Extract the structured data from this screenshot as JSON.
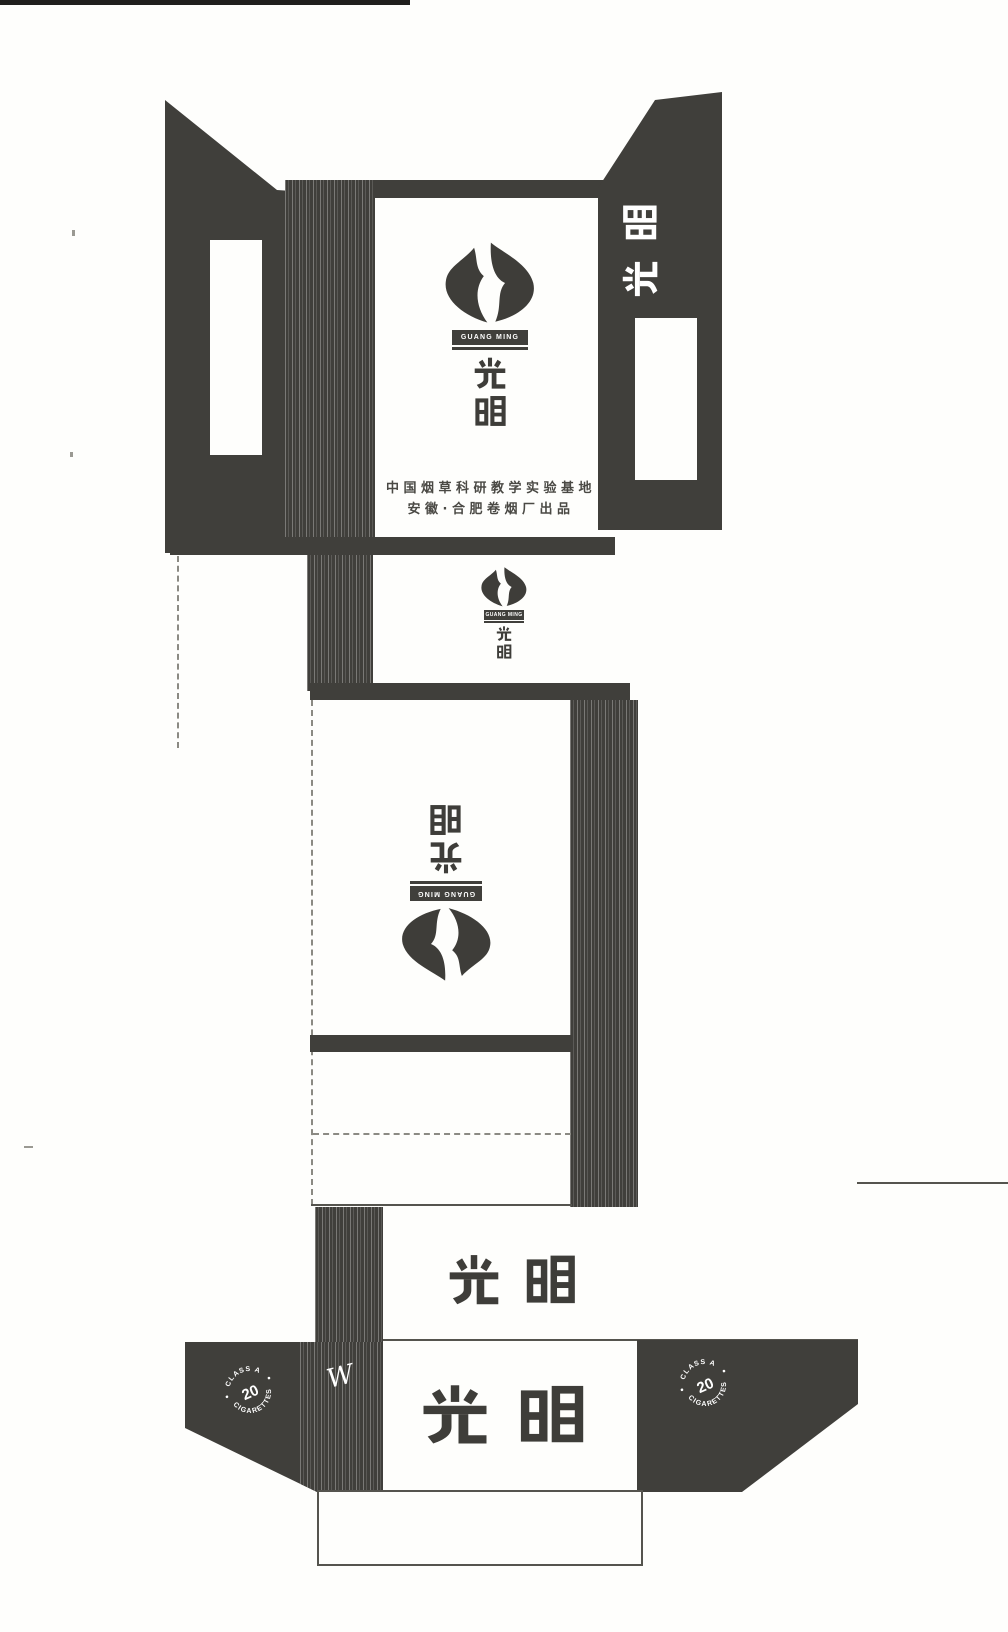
{
  "brand": {
    "name": "光明",
    "char_guang": "光",
    "char_ming": "明",
    "pinyin": "GUANG MING"
  },
  "banner": {
    "text": "GUANG MING"
  },
  "maker": {
    "line1": "中国烟草科研教学实验基地",
    "line2": "安徽·合肥卷烟厂出品"
  },
  "stamp": {
    "arc_top": "CLASS A",
    "center": "20",
    "arc_bottom": "CIGARETTES"
  },
  "marks": {
    "script": "W"
  },
  "colors": {
    "ink": "#403f3b",
    "paper": "#fefefc"
  }
}
